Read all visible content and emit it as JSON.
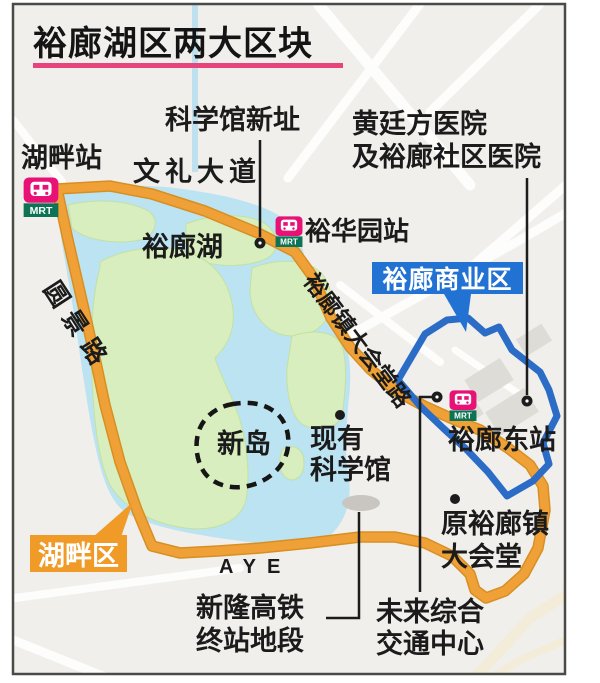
{
  "title": "裕廊湖区两大区块",
  "zones": {
    "business": {
      "label": "裕廊商业区"
    },
    "lakeside": {
      "label": "湖畔区"
    }
  },
  "stations": {
    "lakeside": {
      "name": "湖畔站",
      "badge": "MRT"
    },
    "chinese_garden": {
      "name": "裕华园站",
      "badge": "MRT"
    },
    "jurong_east": {
      "name": "裕廊东站",
      "badge": "MRT"
    }
  },
  "roads": {
    "boon_lay_way": "文礼大道",
    "yuan_ching_road": "圆景路",
    "town_hall_road": "裕廊镇大会堂路",
    "aye": "AYE"
  },
  "places": {
    "science_centre_new": "科学馆新址",
    "hospital_line1": "黄廷方医院",
    "hospital_line2": "及裕廊社区医院",
    "jurong_lake": "裕廊湖",
    "new_island": "新岛",
    "existing_science_line1": "现有",
    "existing_science_line2": "科学馆",
    "former_town_hall_line1": "原裕廊镇",
    "former_town_hall_line2": "大会堂",
    "future_hub_line1": "未来综合",
    "future_hub_line2": "交通中心",
    "hsr_line1": "新隆高铁",
    "hsr_line2": "终站地段"
  },
  "colors": {
    "road_orange": "#efa138",
    "district_blue": "#2a6cc6",
    "business_label_bg": "#2272d4",
    "lakeside_label_bg": "#f09a28",
    "title_underline": "#e8447c",
    "mrt_pink": "#e81277",
    "mrt_green": "#0d7355",
    "lake_blue": "#bce3f2",
    "island_green": "#d8eebf"
  }
}
